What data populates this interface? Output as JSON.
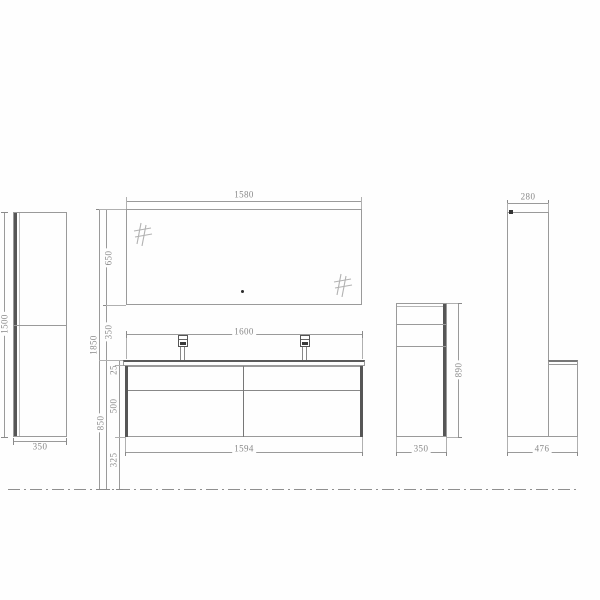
{
  "drawing": {
    "kind": "bathroom-vanity-set-dimension-drawing",
    "units": "mm",
    "line_color": "#9a9a9a",
    "accent_dark": "#565656",
    "text_color": "#888888"
  },
  "dims": {
    "mirror_width": "1580",
    "mirror_height": "650",
    "mirror_to_counter_gap": "350",
    "overall_height": "1850",
    "countertop_width": "1600",
    "countertop_thickness": "25",
    "vanity_body_height": "500",
    "counter_height_from_floor": "850",
    "floor_clearance": "325",
    "vanity_body_width": "1594",
    "left_cabinet_height": "1500",
    "left_cabinet_width": "350",
    "side_cabinet_height": "890",
    "side_cabinet_width": "350",
    "tall_cabinet_depth": "280",
    "overall_depth": "476"
  }
}
